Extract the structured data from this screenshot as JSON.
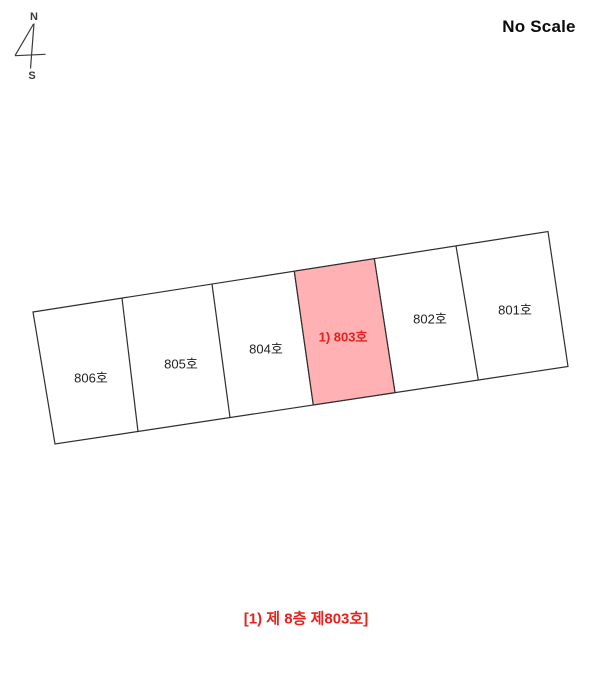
{
  "scale_note": "No Scale",
  "compass": {
    "north": "N",
    "south": "S"
  },
  "floor_plan": {
    "floor": "8",
    "units": [
      {
        "number": "806",
        "label": "806호",
        "highlighted": false
      },
      {
        "number": "805",
        "label": "805호",
        "highlighted": false
      },
      {
        "number": "804",
        "label": "804호",
        "highlighted": false
      },
      {
        "number": "803",
        "label": "1) 803호",
        "highlighted": true
      },
      {
        "number": "802",
        "label": "802호",
        "highlighted": false
      },
      {
        "number": "801",
        "label": "801호",
        "highlighted": false
      }
    ],
    "highlight_fill": "#ffb1b3",
    "highlight_text_color": "#e8211d",
    "line_color": "#2e2e2e"
  },
  "caption": "[1) 제 8층 제803호]"
}
